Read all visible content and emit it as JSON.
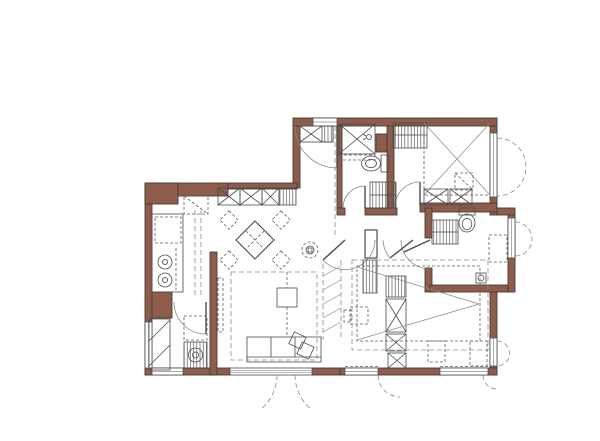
{
  "colors": {
    "bg": "#ffffff",
    "wall": "#8e5c4b",
    "wall_stroke": "#433d38",
    "line": "#4b4b4b",
    "line_soft": "#8a8a8a",
    "dash": "#5f5f5f"
  },
  "legend": {
    "drawing_type": "apartment floor plan",
    "symbols": [
      "entry-door-swing",
      "shoe-cabinet",
      "wardrobe-xbox",
      "shelf-hatch",
      "shower",
      "toilet",
      "vanity-cabinet",
      "floor-drain",
      "double-bed",
      "single-bed",
      "desk",
      "nightstand",
      "dining-table",
      "dining-chair",
      "ceiling-light",
      "kitchen-counter",
      "cooktop-burner",
      "fridge",
      "sofa",
      "coffee-table",
      "side-table",
      "tv-panel",
      "rug",
      "washer-dryer-stack",
      "screen-partition",
      "window",
      "casement-swing"
    ]
  }
}
